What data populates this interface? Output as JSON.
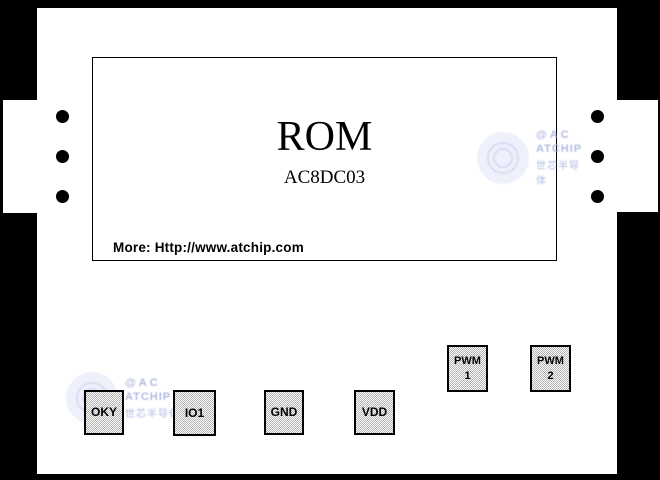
{
  "colors": {
    "background": "#000000",
    "board": "#ffffff",
    "pad_fill_dither": "#b4b4b4",
    "pad_border": "#000000",
    "text": "#000000",
    "watermark_blue": "#a3afdd"
  },
  "chip": {
    "title": "ROM",
    "part_number": "AC8DC03",
    "more_info": "More: Http://www.atchip.com"
  },
  "pads": [
    {
      "name": "OKY",
      "line1": "OKY"
    },
    {
      "name": "IO1",
      "line1": "IO1"
    },
    {
      "name": "GND",
      "line1": "GND"
    },
    {
      "name": "VDD",
      "line1": "VDD"
    },
    {
      "name": "PWM1",
      "line1": "PWM",
      "line2": "1"
    },
    {
      "name": "PWM2",
      "line1": "PWM",
      "line2": "2"
    }
  ],
  "watermark": {
    "line1": "@AC",
    "line2": "ATCHIP",
    "line3": "世芯半导体"
  },
  "icons": {
    "pin_hole_dot": "●",
    "atchip_logo": "dotted-circle-emblem"
  }
}
